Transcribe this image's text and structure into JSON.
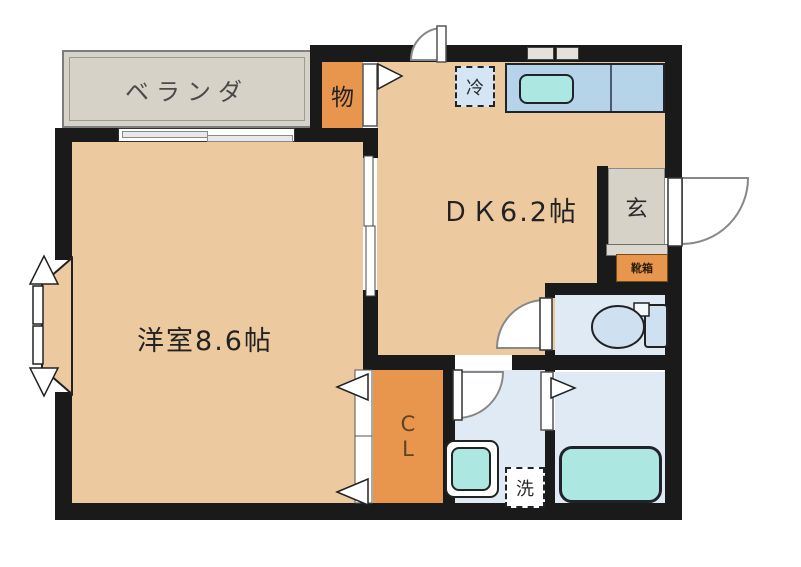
{
  "plan": {
    "rooms": {
      "veranda": {
        "label": "ベランダ"
      },
      "storage": {
        "label": "物"
      },
      "dining_kitchen": {
        "label": "ＤＫ6.2帖",
        "size_tatami": 6.2
      },
      "entrance": {
        "label": "玄"
      },
      "shoe_cabinet": {
        "label": "靴箱"
      },
      "western_room": {
        "label": "洋室8.6帖",
        "size_tatami": 8.6
      },
      "closet": {
        "label": "CL",
        "line1": "C",
        "line2": "L"
      }
    },
    "fixtures": {
      "refrigerator": {
        "label": "冷"
      },
      "washing_machine": {
        "label": "洗"
      }
    },
    "colors": {
      "wall": "#1a1a1a",
      "room_floor": "#edc9a0",
      "storage_orange": "#e8964e",
      "gray_area": "#d6d2c8",
      "wet_area_blue": "#dfeaf5",
      "counter_blue": "#b5d3e9",
      "fixture_cyan": "#ade7e1"
    }
  }
}
